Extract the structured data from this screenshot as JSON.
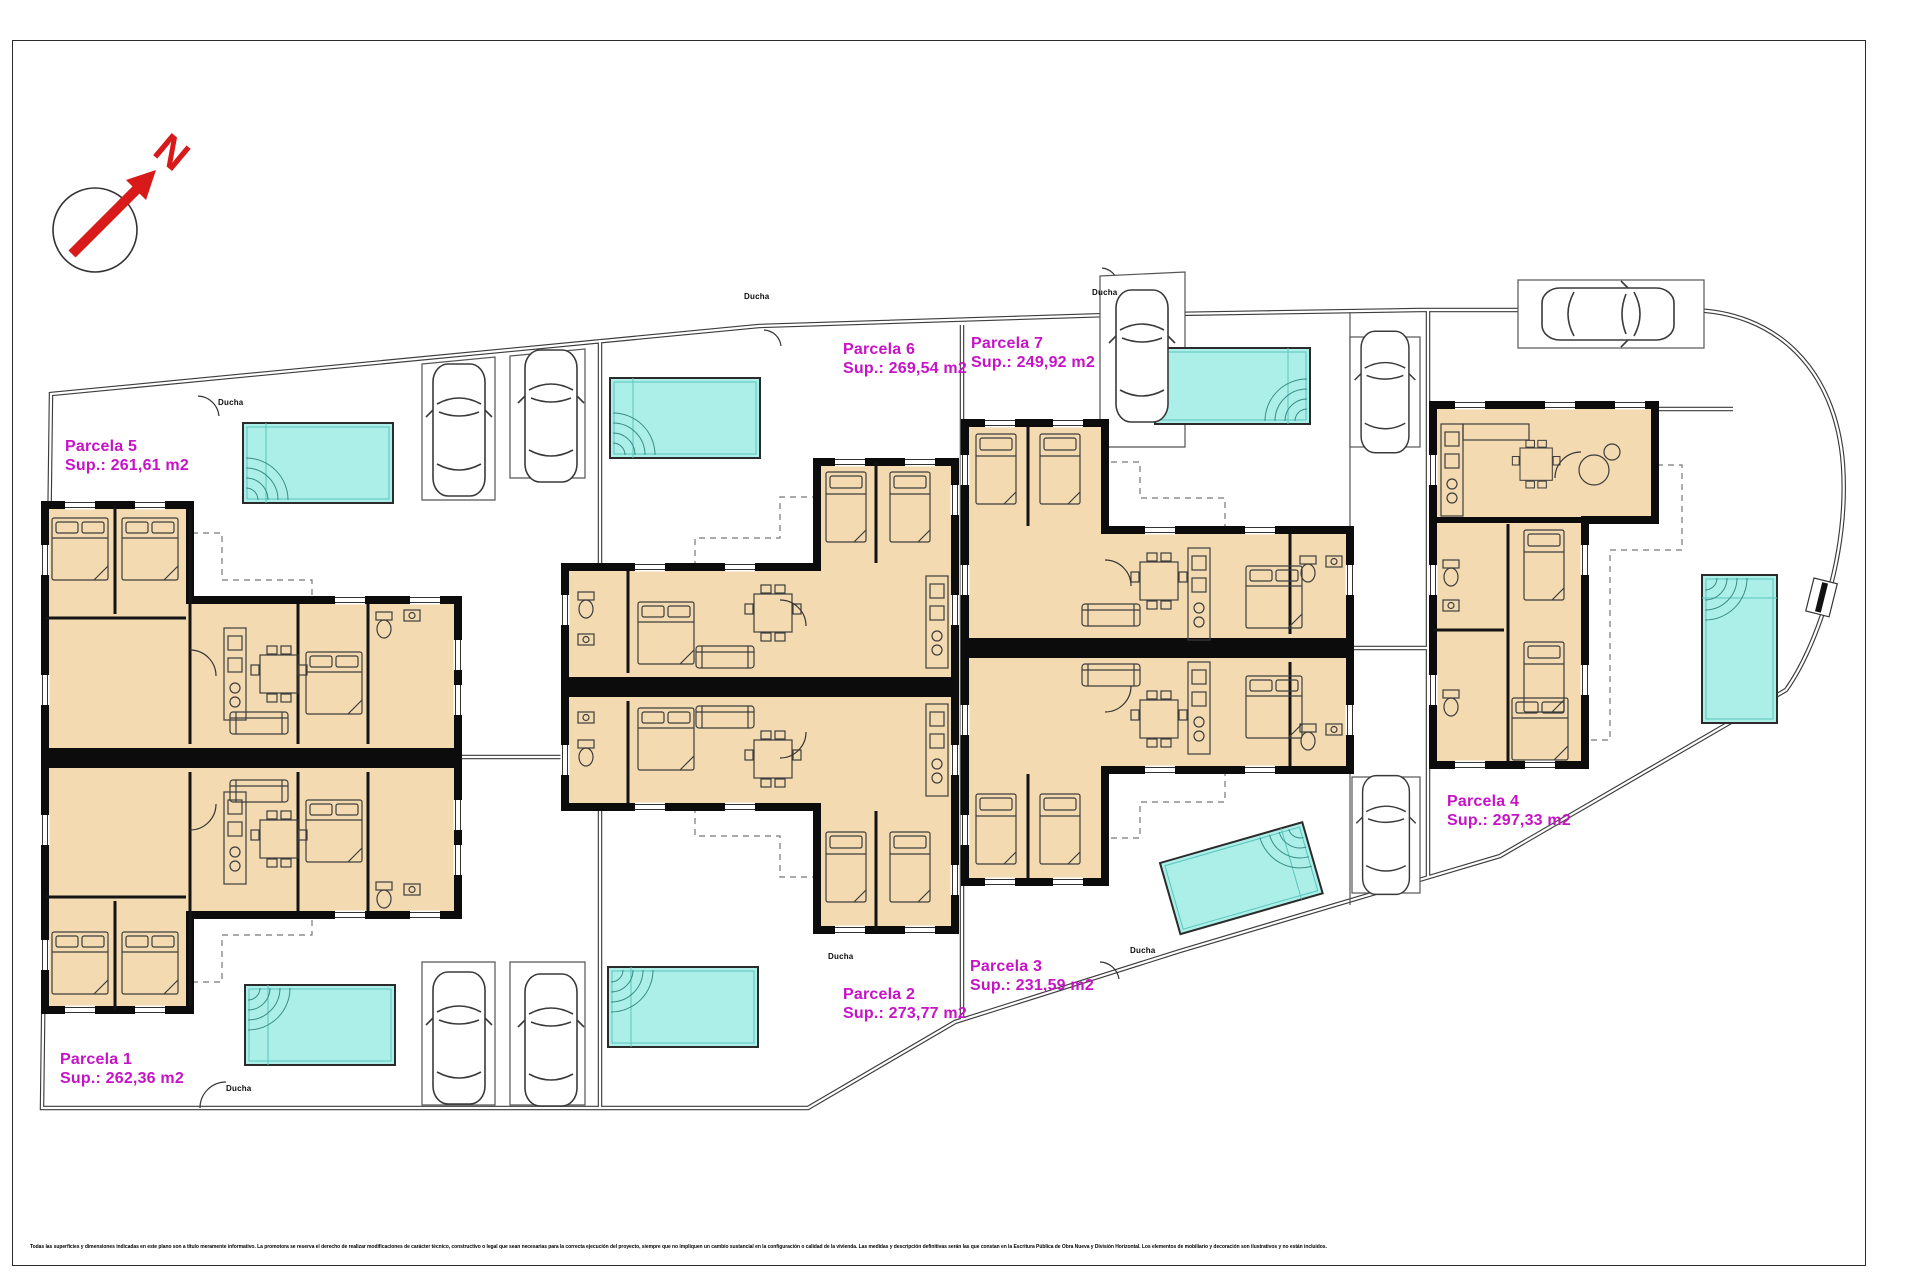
{
  "plan": {
    "north_label": "N",
    "shower_label": "Ducha",
    "disclaimer": "Todas las superficies y dimensiones indicadas en este plano son a título meramente informativo. La promotora se reserva el derecho de realizar modificaciones de carácter técnico, constructivo o legal que sean necesarias para la correcta ejecución del proyecto, siempre que no impliquen un cambio sustancial en la configuración o calidad de la vivienda. Las medidas y descripción definitivas serán las que constan en la Escritura Pública de Obra Nueva y División Horizontal. Los elementos de mobiliario y decoración son ilustrativos y no están incluidos."
  },
  "parcels": [
    {
      "name": "Parcela 1",
      "area": "Sup.: 262,36 m2"
    },
    {
      "name": "Parcela 2",
      "area": "Sup.: 273,77 m2"
    },
    {
      "name": "Parcela 3",
      "area": "Sup.: 231,59 m2"
    },
    {
      "name": "Parcela 4",
      "area": "Sup.: 297,33 m2"
    },
    {
      "name": "Parcela 5",
      "area": "Sup.: 261,61 m2"
    },
    {
      "name": "Parcela 6",
      "area": "Sup.: 269,54 m2"
    },
    {
      "name": "Parcela 7",
      "area": "Sup.: 249,92 m2"
    }
  ],
  "colors": {
    "building_fill": "#f3dab1",
    "wall": "#0c0c0c",
    "pool_fill": "#abefe8",
    "parcel_label": "#c613c6",
    "north_arrow": "#d81a1a"
  }
}
